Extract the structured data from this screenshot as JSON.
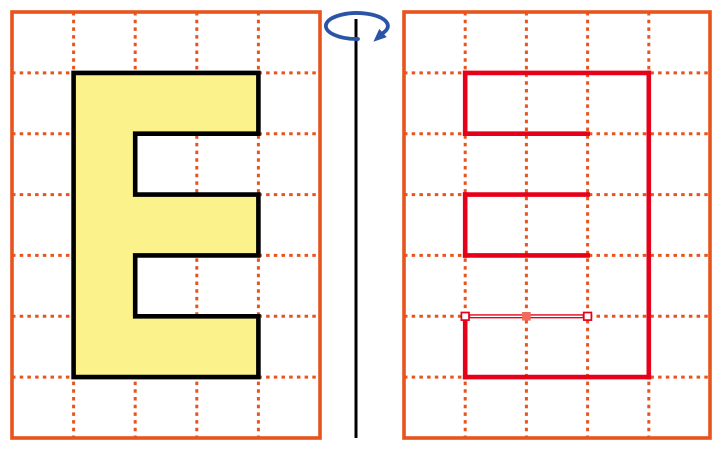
{
  "colors": {
    "background": "#FFFFFF",
    "grid_orange": "#E8541E",
    "trace_red": "#E60019",
    "letter_fill": "#FBF28B",
    "letter_outline": "#000000",
    "axis_black": "#000000",
    "arrow_blue": "#2B54A6",
    "handle_fill": "#FFFFFF",
    "handle_border": "#E60019",
    "handle_mid_fill": "#F26A5A",
    "selected_core": "#FFFFFF"
  },
  "panels": {
    "left": {
      "x": 12,
      "y": 12,
      "width": 308,
      "height": 426,
      "cols": 5,
      "rows": 7
    },
    "right": {
      "x": 404,
      "y": 12,
      "width": 306,
      "height": 426,
      "cols": 5,
      "rows": 7
    }
  },
  "letter": {
    "glyph": "E",
    "points": [
      [
        73.6,
        72.9
      ],
      [
        258.4,
        72.9
      ],
      [
        258.4,
        133.7
      ],
      [
        135.2,
        133.7
      ],
      [
        135.2,
        194.6
      ],
      [
        258.4,
        194.6
      ],
      [
        258.4,
        255.4
      ],
      [
        135.2,
        255.4
      ],
      [
        135.2,
        316.3
      ],
      [
        258.4,
        316.3
      ],
      [
        258.4,
        377.1
      ],
      [
        73.6,
        377.1
      ]
    ]
  },
  "mirror_trace": {
    "segments": [
      {
        "from": [
          465.2,
          72.9
        ],
        "to": [
          648.8,
          72.9
        ]
      },
      {
        "from": [
          648.8,
          72.9
        ],
        "to": [
          648.8,
          377.1
        ]
      },
      {
        "from": [
          465.2,
          377.1
        ],
        "to": [
          648.8,
          377.1
        ]
      },
      {
        "from": [
          465.2,
          72.9
        ],
        "to": [
          465.2,
          133.7
        ]
      },
      {
        "from": [
          465.2,
          133.7
        ],
        "to": [
          587.6,
          133.7
        ]
      },
      {
        "from": [
          465.2,
          194.6
        ],
        "to": [
          587.6,
          194.6
        ]
      },
      {
        "from": [
          465.2,
          194.6
        ],
        "to": [
          465.2,
          255.4
        ]
      },
      {
        "from": [
          465.2,
          255.4
        ],
        "to": [
          587.6,
          255.4
        ]
      },
      {
        "from": [
          465.2,
          316.3
        ],
        "to": [
          465.2,
          377.1
        ]
      }
    ],
    "selected_segment": {
      "from": [
        465.2,
        316.3
      ],
      "to": [
        587.6,
        316.3
      ],
      "midpoint": [
        526.4,
        316.3
      ]
    }
  },
  "axis": {
    "x": 356,
    "y1": 19,
    "y2": 438
  },
  "rotation_arrow": {
    "cx": 361,
    "cy": 26,
    "rx": 31,
    "ry": 13
  }
}
